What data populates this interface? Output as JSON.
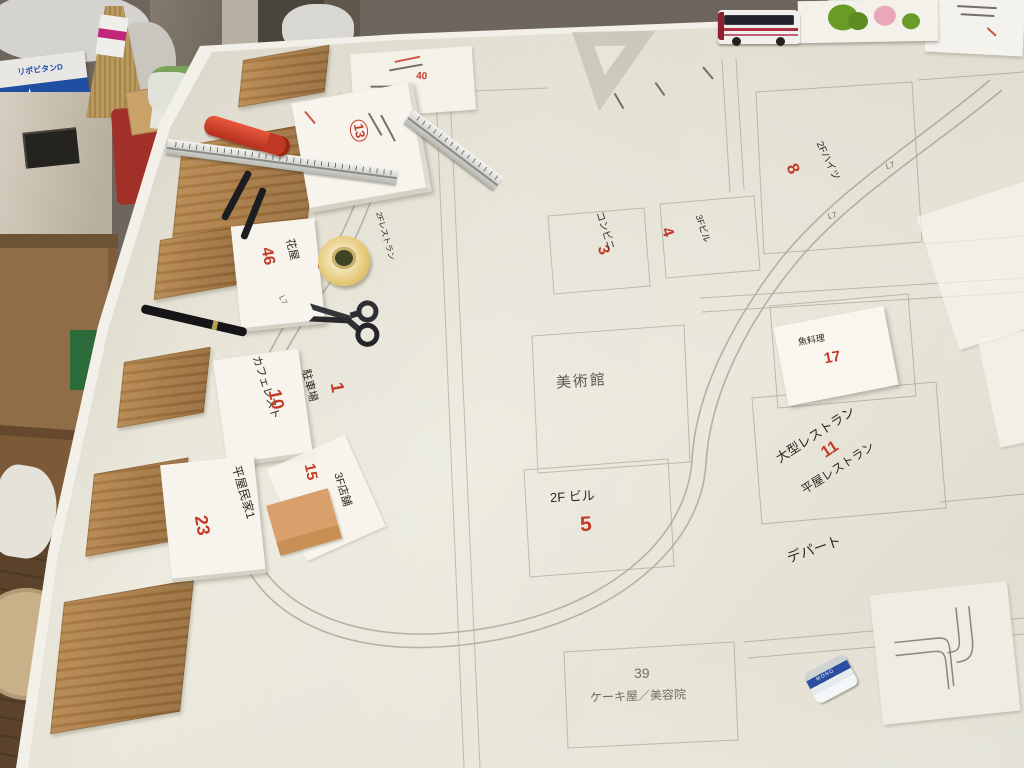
{
  "scene": {
    "description": "Photograph: large white model-railway town planning board on a workbench with pencil plot grid, a drawn track loop, handwritten Japanese lot labels with red numbers, and craft tools",
    "board_labels": {
      "museum": {
        "text": "美術館"
      },
      "bldg2f": {
        "text": "2F ビル",
        "num": "5"
      },
      "plot39": {
        "num": "39",
        "text": "ケーキ屋／美容院"
      },
      "depart": {
        "text": "デパート"
      },
      "large_restaurant": {
        "text": "大型レストラン",
        "num": "11",
        "sub": "平屋レストラン"
      },
      "fish": {
        "text": "魚料理",
        "num": "17"
      },
      "heights": {
        "num": "8",
        "text": "2Fハイツ"
      },
      "conbini": {
        "num": "3",
        "text": "コンビニ"
      },
      "bldg3f": {
        "num": "4",
        "text": "3Fビル"
      },
      "parking": {
        "num": "1",
        "text": "駐車場"
      },
      "shop3f": {
        "num": "15",
        "text": "3F店舗"
      },
      "num6": {
        "num": "6",
        "text": "2Fレストラン"
      },
      "num13": {
        "num": "13"
      },
      "num40": {
        "num": "40"
      }
    },
    "cards": {
      "cafe": {
        "text": "カフェレスト",
        "num": "10"
      },
      "hiraya": {
        "text": "平屋民家1",
        "num": "23"
      },
      "hanaya": {
        "text": "花屋",
        "num": "46"
      }
    },
    "track_marks": [
      "L7",
      "L7",
      "L7"
    ],
    "objects": {
      "battery_label": "MONO",
      "drink_box": "リポビタンD"
    },
    "colors": {
      "board": "#e9e6da",
      "pencil": "#a39e91",
      "red_ink": "#c43a28",
      "black_ink": "#2c2822",
      "wood_panel": "#a5783f",
      "masking_tape": "#e2c268"
    }
  }
}
